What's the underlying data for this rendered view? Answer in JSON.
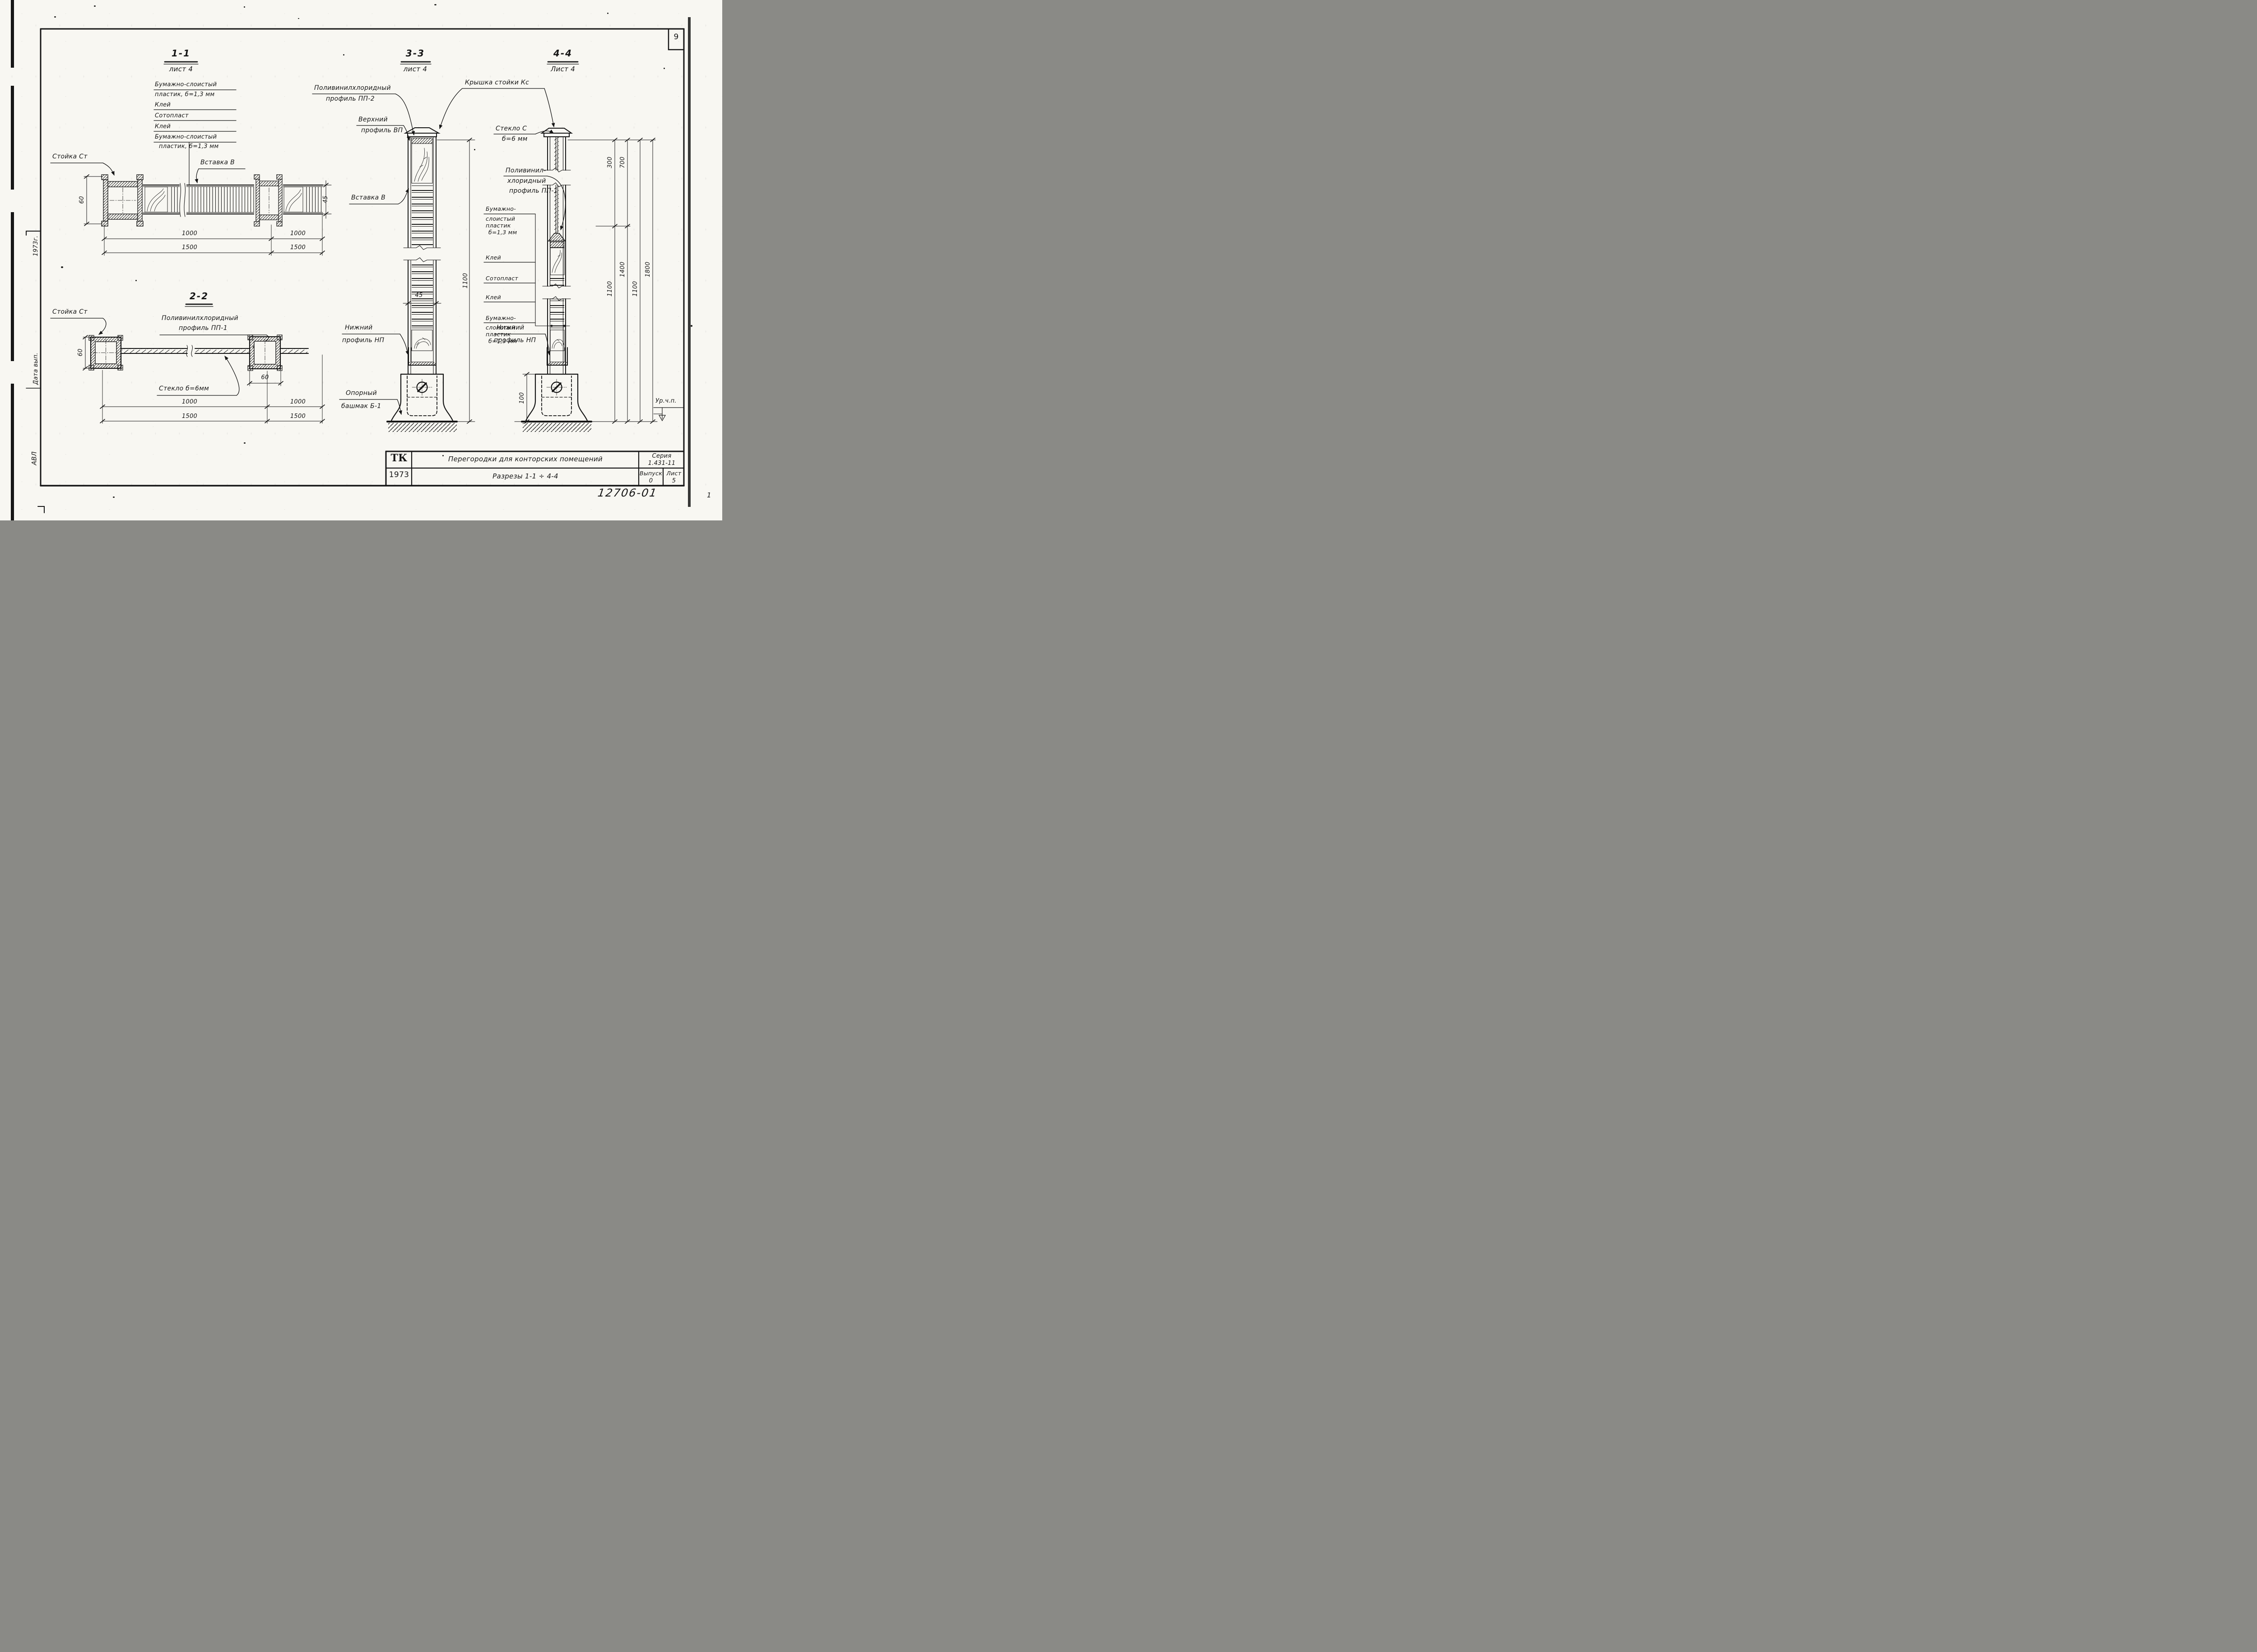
{
  "page": {
    "number": "9"
  },
  "margin": {
    "year": "1973г.",
    "date_label": "Дата вып.",
    "initials": "АВЛ",
    "corner_mark": "1"
  },
  "section_1_1": {
    "title": "1-1",
    "sheet_ref": "лист 4",
    "layers": [
      "Бумажно-слоистый",
      "пластик, б=1,3 мм",
      "Клей",
      "Сотопласт",
      "Клей",
      "Бумажно-слоистый",
      "пластик, б=1,3 мм"
    ],
    "labels": {
      "post": "Стойка Ст",
      "insert": "Вставка В"
    },
    "dims": {
      "post_height": "60",
      "panel_thickness": "45",
      "spans": [
        "1000",
        "1000"
      ],
      "modules": [
        "1500",
        "1500"
      ]
    }
  },
  "section_2_2": {
    "title": "2-2",
    "labels": {
      "post": "Стойка Ст",
      "profile": [
        "Поливинилхлоридный",
        "профиль ПП-1"
      ],
      "glass": "Стекло б=6мм"
    },
    "dims": {
      "post_height": "60",
      "post_width": "60",
      "spans": [
        "1000",
        "1000"
      ],
      "modules": [
        "1500",
        "1500"
      ]
    }
  },
  "section_3_3": {
    "title": "3-3",
    "sheet_ref": "лист 4",
    "labels": {
      "pvc_profile": [
        "Поливинилхлоридный",
        "профиль ПП-2"
      ],
      "cap": "Крышка стойки Кс",
      "top_profile": [
        "Верхний",
        "профиль ВП"
      ],
      "insert": "Вставка В",
      "bottom_profile": [
        "Нижний",
        "профиль НП"
      ],
      "shoe": [
        "Опорный",
        "башмак Б-1"
      ]
    },
    "dims": {
      "insert_width": "45",
      "height": "1100"
    }
  },
  "section_4_4": {
    "title": "4-4",
    "sheet_ref": "Лист 4",
    "labels": {
      "glass": [
        "Стекло С",
        "б=6 мм"
      ],
      "pvc_profile": [
        "Поливинил-",
        "хлоридный",
        "профиль ПП-1"
      ],
      "layers": [
        "Бумажно-",
        "слоистый",
        "пластик",
        "б=1,3 мм",
        "Клей",
        "Сотопласт",
        "Клей",
        "Бумажно-",
        "слоистый",
        "пластик",
        "б=1,3 мм"
      ],
      "bottom_profile": [
        "Нижний",
        "профиль НП"
      ]
    },
    "dims": {
      "top": [
        "300",
        "700"
      ],
      "lower": [
        "1100",
        "1400",
        "1100",
        "1800"
      ],
      "base": "100"
    },
    "level_mark": "Ур.ч.п."
  },
  "title_block": {
    "logo": "ТК",
    "year": "1973",
    "title": "Перегородки для конторских помещений",
    "subtitle": "Разрезы 1-1 ÷ 4-4",
    "series_label": "Серия",
    "series": "1.431-11",
    "issue_label": "Выпуск",
    "issue": "0",
    "sheet_label": "Лист",
    "sheet": "5",
    "stamp": "12706-01"
  }
}
